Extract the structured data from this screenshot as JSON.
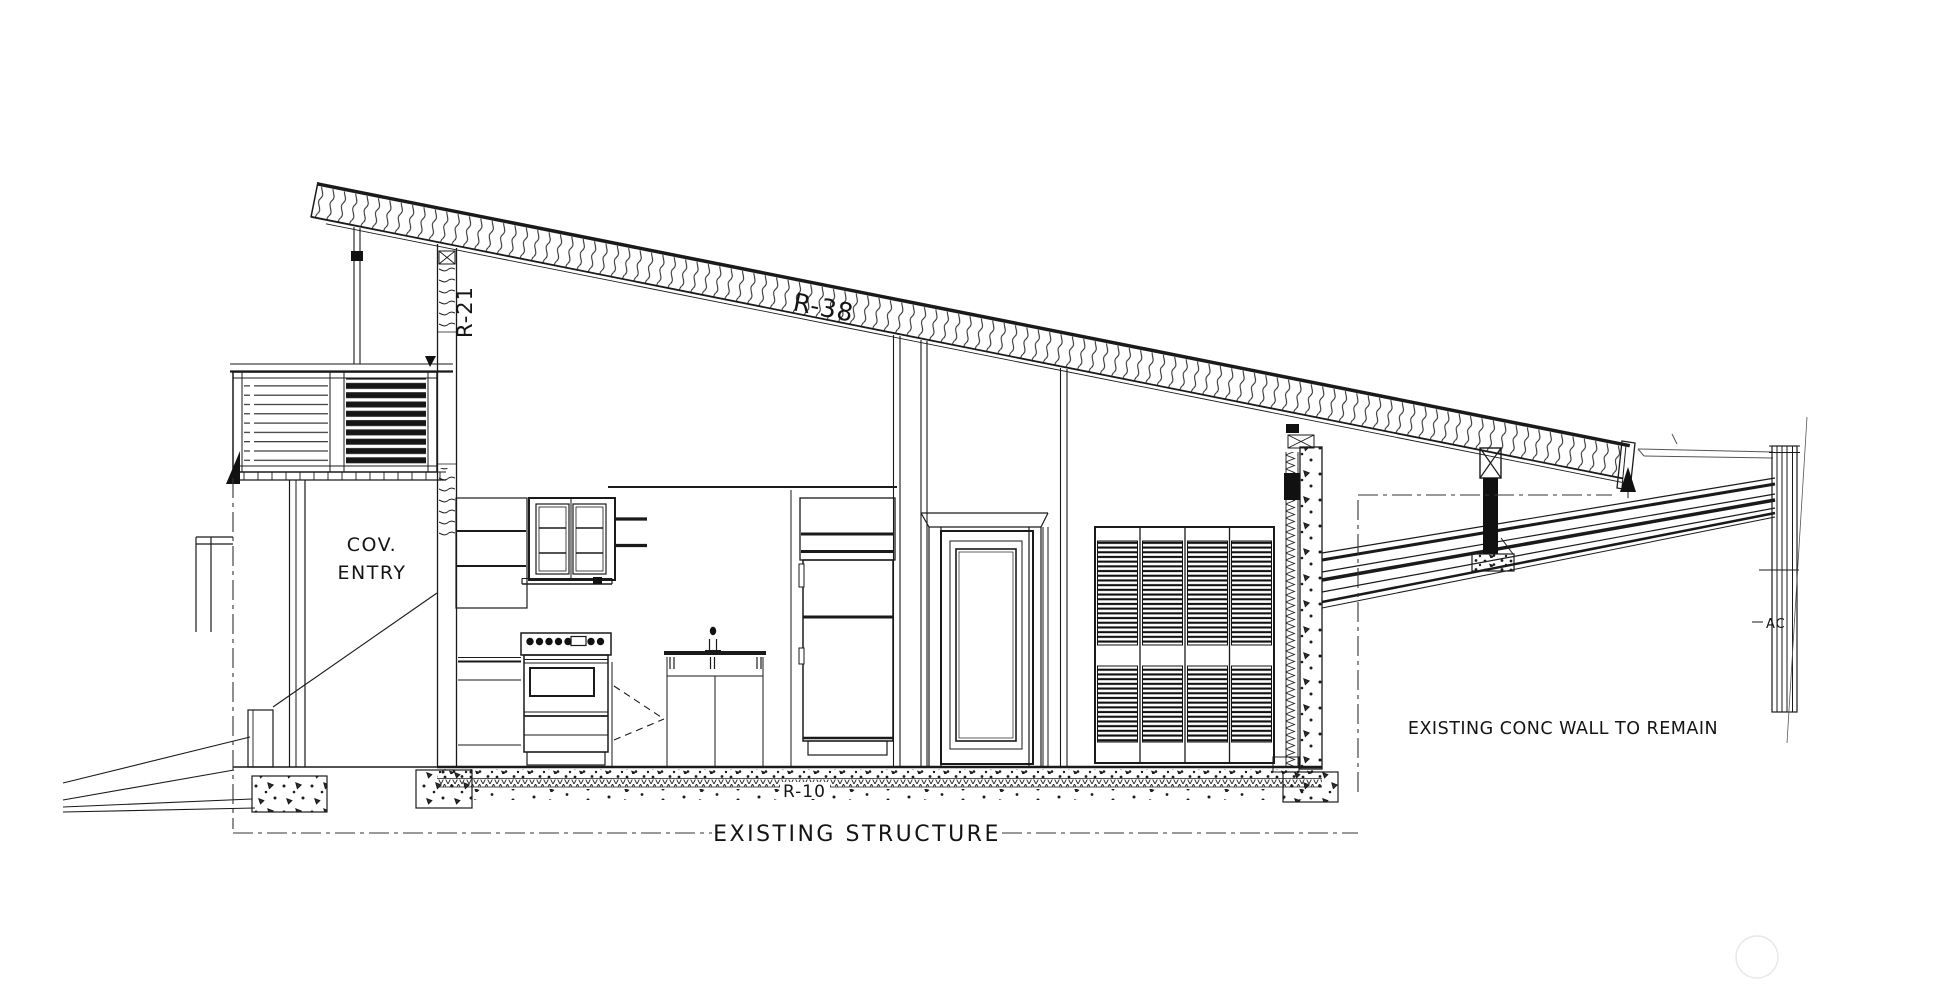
{
  "document": {
    "type": "architectural-section-drawing",
    "background": "#ffffff",
    "ink_color": "#1a1a1a",
    "faint_color": "#e8e8e8"
  },
  "labels": {
    "roof_insulation": "R-38",
    "wall_insulation": "R-21",
    "slab_insulation": "R-10",
    "entry_line1": "COV.",
    "entry_line2": "ENTRY",
    "existing_structure": "EXISTING STRUCTURE",
    "conc_wall_note": "EXISTING CONC WALL TO REMAIN",
    "ac_note": "AC"
  },
  "components": [
    "sloped-shed-roof-batt-insulation",
    "clerestory-stud-wall",
    "roof-outrigger-post",
    "entry-louver-screen",
    "covered-entry-porch",
    "site-wing-wall",
    "grade-slope-lines",
    "entry-step",
    "porch-post",
    "open-shelving",
    "glass-front-upper-cabinet",
    "floating-shelves",
    "range-oven",
    "dishwasher",
    "kitchen-sink-and-faucet",
    "sink-base-cabinet",
    "refrigerator-with-upper-cabinet",
    "interior-paneled-door",
    "louvered-closet-doors",
    "concrete-wall-section",
    "wall-furring-insulation",
    "slab-on-grade-with-rigid-insulation",
    "concrete-footings",
    "existing-carport-beams",
    "roof-strut-post",
    "existing-wall-post",
    "datum-arrows",
    "existing-structure-boundary"
  ]
}
